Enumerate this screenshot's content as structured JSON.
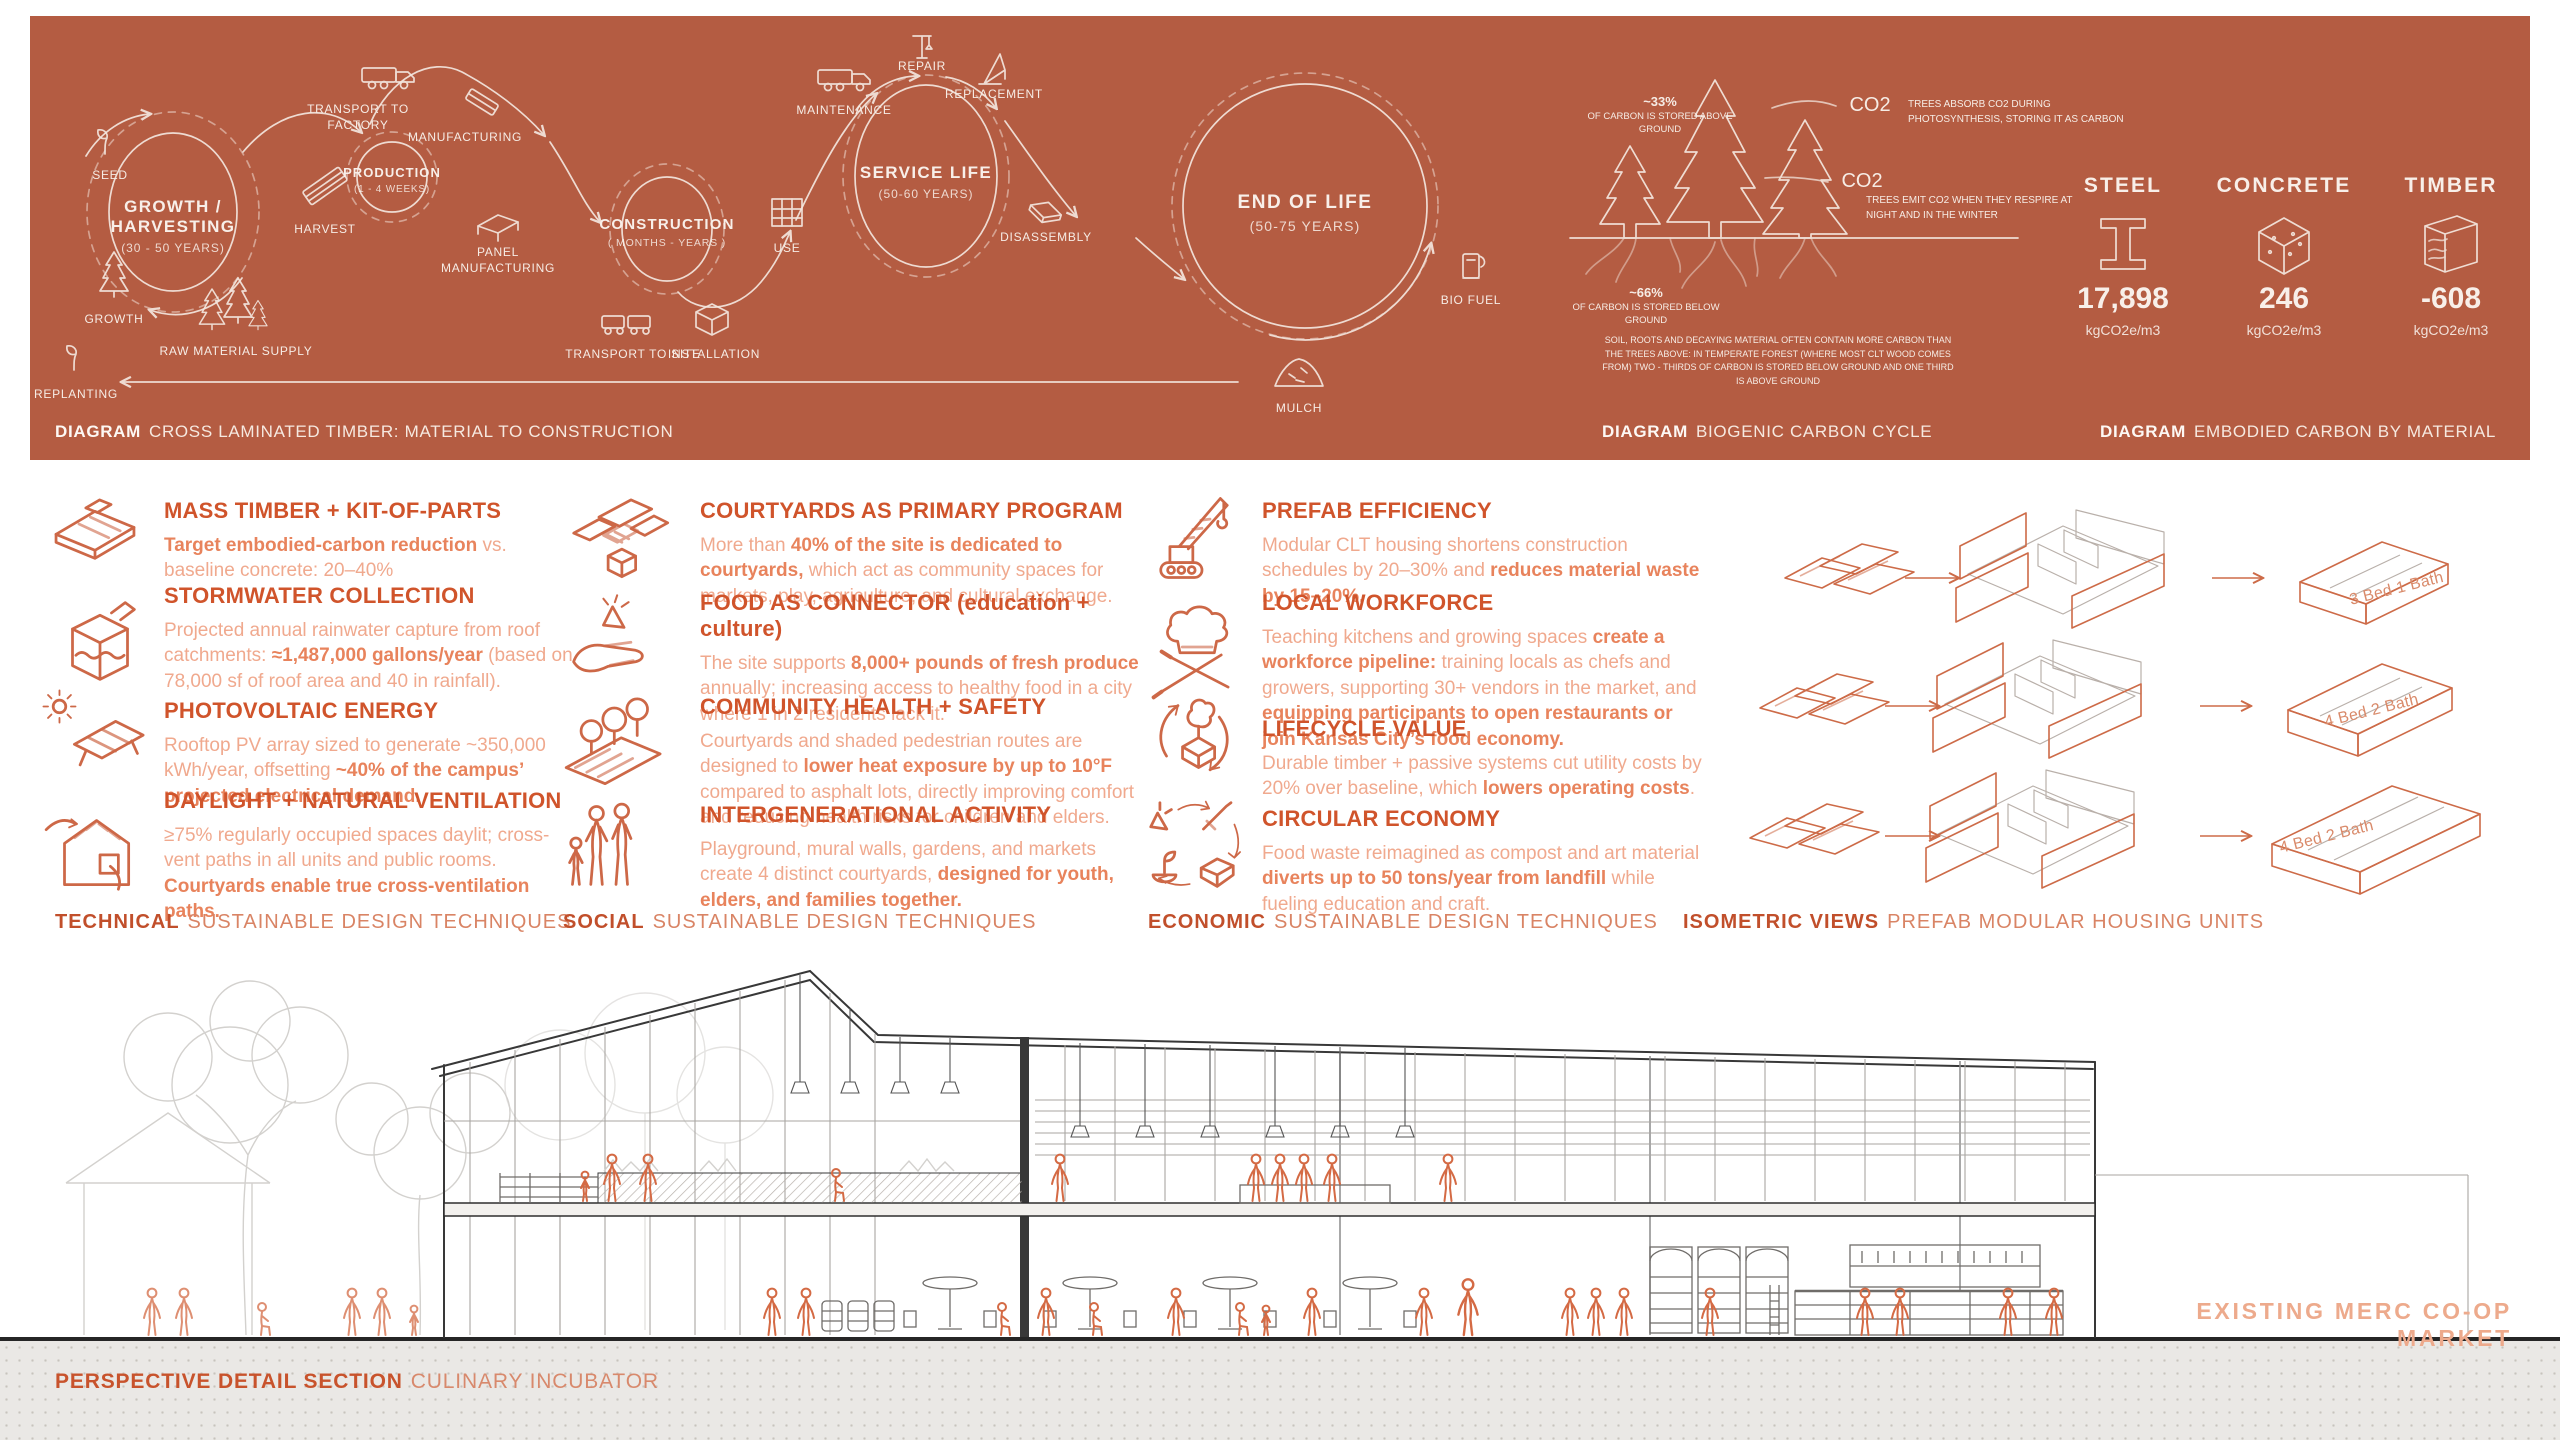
{
  "colors": {
    "band_bg": "#b45c42",
    "accent": "#d0542b",
    "body_light": "#f0a98e",
    "body_bold": "#e8835c",
    "band_ink": "#f6ece5",
    "figure_orange": "#d46a44",
    "ground_gray": "#eae8e5"
  },
  "band": {
    "captions": [
      {
        "tag": "DIAGRAM",
        "title": "CROSS LAMINATED TIMBER: MATERIAL TO CONSTRUCTION"
      },
      {
        "tag": "DIAGRAM",
        "title": "BIOGENIC CARBON CYCLE"
      },
      {
        "tag": "DIAGRAM",
        "title": "EMBODIED CARBON BY MATERIAL"
      }
    ],
    "lifecycle": {
      "circles": [
        {
          "title": "GROWTH / HARVESTING",
          "sub": "(30 - 50 YEARS)"
        },
        {
          "title": "PRODUCTION",
          "sub": "(1 - 4 WEEKS)"
        },
        {
          "title": "CONSTRUCTION",
          "sub": "( MONTHS - YEARS )"
        },
        {
          "title": "SERVICE LIFE",
          "sub": "(50-60 YEARS)"
        },
        {
          "title": "END OF LIFE",
          "sub": "(50-75 YEARS)"
        }
      ],
      "labels": {
        "seed": "SEED",
        "growth": "GROWTH",
        "replanting": "REPLANTING",
        "harvest": "HARVEST",
        "raw_supply": "RAW MATERIAL SUPPLY",
        "to_factory": "TRANSPORT TO FACTORY",
        "manufacturing": "MANUFACTURING",
        "panel_mfg": "PANEL MANUFACTURING",
        "to_site": "TRANSPORT TO SITE",
        "installation": "INSTALLATION",
        "use": "USE",
        "maintenance": "MAINTENANCE",
        "repair": "REPAIR",
        "replacement": "REPLACEMENT",
        "disassembly": "DISASSEMBLY",
        "bio_fuel": "BIO FUEL",
        "mulch": "MULCH"
      }
    },
    "biogenic": {
      "above_pct": "~33%",
      "above_note": "OF CARBON IS STORED ABOVE GROUND",
      "co2_a": "CO2",
      "co2_a_note": "TREES ABSORB CO2 DURING PHOTOSYNTHESIS, STORING IT AS CARBON",
      "co2_b": "CO2",
      "co2_b_note": "TREES EMIT CO2 WHEN THEY RESPIRE AT NIGHT AND IN THE WINTER",
      "below_pct": "~66%",
      "below_note": "OF CARBON IS STORED BELOW GROUND",
      "footnote": "SOIL, ROOTS AND DECAYING MATERIAL OFTEN CONTAIN MORE CARBON THAN THE TREES ABOVE: IN TEMPERATE FOREST (WHERE MOST CLT WOOD COMES FROM) TWO - THIRDS OF CARBON IS STORED BELOW GROUND AND ONE THIRD IS ABOVE GROUND"
    },
    "materials": [
      {
        "name": "STEEL",
        "value": "17,898",
        "unit": "kgCO2e/m3",
        "icon": "steel-ibeam-icon"
      },
      {
        "name": "CONCRETE",
        "value": "246",
        "unit": "kgCO2e/m3",
        "icon": "concrete-cube-icon"
      },
      {
        "name": "TIMBER",
        "value": "-608",
        "unit": "kgCO2e/m3",
        "icon": "timber-block-icon"
      }
    ]
  },
  "features": {
    "technical": {
      "footer": {
        "tag": "TECHNICAL",
        "title": "SUSTAINABLE DESIGN TECHNIQUES"
      },
      "items": [
        {
          "icon": "mass-timber-icon",
          "title": "MASS TIMBER + KIT-OF-PARTS",
          "body": [
            {
              "t": "Target embodied-carbon reduction",
              "b": true
            },
            {
              "t": " vs. baseline concrete: 20–40%",
              "b": false
            }
          ]
        },
        {
          "icon": "stormwater-icon",
          "title": "STORMWATER COLLECTION",
          "body": [
            {
              "t": "Projected annual rainwater capture from roof catchments: ",
              "b": false
            },
            {
              "t": "≈1,487,000 gallons/year",
              "b": true
            },
            {
              "t": " (based on 78,000 sf of roof area and 40 in rainfall).",
              "b": false
            }
          ]
        },
        {
          "icon": "photovoltaic-icon",
          "title": "PHOTOVOLTAIC ENERGY",
          "body": [
            {
              "t": "Rooftop PV array sized to generate ~350,000 kWh/year, offsetting ",
              "b": false
            },
            {
              "t": "~40% of the campus’ projected electrical demand.",
              "b": true
            }
          ]
        },
        {
          "icon": "daylight-ventilation-icon",
          "title": "DAYLIGHT + NATURAL VENTILATION",
          "body": [
            {
              "t": "≥75% regularly occupied spaces daylit; cross-vent paths in all units and public rooms. ",
              "b": false
            },
            {
              "t": "Courtyards enable true cross-ventilation paths.",
              "b": true
            }
          ]
        }
      ]
    },
    "social": {
      "footer": {
        "tag": "SOCIAL",
        "title": "SUSTAINABLE DESIGN TECHNIQUES"
      },
      "items": [
        {
          "icon": "courtyard-icon",
          "title": "COURTYARDS AS PRIMARY PROGRAM",
          "body": [
            {
              "t": "More than ",
              "b": false
            },
            {
              "t": "40% of the site is dedicated to courtyards,",
              "b": true
            },
            {
              "t": " which act as community spaces for markets, play, agriculture, and cultural exchange.",
              "b": false
            }
          ]
        },
        {
          "icon": "food-hand-icon",
          "title": "FOOD AS CONNECTOR (education + culture)",
          "body": [
            {
              "t": "The site supports ",
              "b": false
            },
            {
              "t": "8,000+ pounds of fresh produce",
              "b": true
            },
            {
              "t": " annually; increasing access to healthy food in a city where 1 in 2 residents lack it.",
              "b": false
            }
          ]
        },
        {
          "icon": "shaded-route-icon",
          "title": "COMMUNITY HEALTH + SAFETY",
          "body": [
            {
              "t": "Courtyards and shaded pedestrian routes are designed to ",
              "b": false
            },
            {
              "t": "lower heat exposure by up to 10°F",
              "b": true
            },
            {
              "t": " compared to asphalt lots, directly improving comfort and reducing health risks for children and elders.",
              "b": false
            }
          ]
        },
        {
          "icon": "family-icon",
          "title": "INTERGENERATIONAL ACTIVITY",
          "body": [
            {
              "t": "Playground, mural walls, gardens, and markets create 4 distinct courtyards, ",
              "b": false
            },
            {
              "t": "designed for youth, elders, and families together.",
              "b": true
            }
          ]
        }
      ]
    },
    "economic": {
      "footer": {
        "tag": "ECONOMIC",
        "title": "SUSTAINABLE DESIGN TECHNIQUES"
      },
      "items": [
        {
          "icon": "crane-icon",
          "title": "PREFAB EFFICIENCY",
          "body": [
            {
              "t": "Modular CLT housing shortens construction schedules by 20–30% and ",
              "b": false
            },
            {
              "t": "reduces material waste by 15–20%.",
              "b": true
            }
          ]
        },
        {
          "icon": "chef-icon",
          "title": "LOCAL WORKFORCE",
          "body": [
            {
              "t": "Teaching kitchens and growing spaces ",
              "b": false
            },
            {
              "t": "create a workforce pipeline:",
              "b": true
            },
            {
              "t": " training locals as chefs and growers, supporting 30+ vendors in the market, and ",
              "b": false
            },
            {
              "t": "equipping participants to open restaurants or join Kansas City’s food economy.",
              "b": true
            }
          ]
        },
        {
          "icon": "lifecycle-tree-icon",
          "title": "LIFECYCLE VALUE",
          "body": [
            {
              "t": "Durable timber + passive systems cut utility costs by 20% over baseline, which ",
              "b": false
            },
            {
              "t": "lowers operating costs",
              "b": true
            },
            {
              "t": ".",
              "b": false
            }
          ]
        },
        {
          "icon": "circular-economy-icon",
          "title": "CIRCULAR ECONOMY",
          "body": [
            {
              "t": "Food waste reimagined as compost and art material ",
              "b": false
            },
            {
              "t": "diverts up to 50 tons/year from landfill",
              "b": true
            },
            {
              "t": " while fueling education and craft.",
              "b": false
            }
          ]
        }
      ]
    }
  },
  "iso": {
    "units": [
      "3 Bed 1 Bath",
      "4 Bed 2 Bath",
      "4 Bed 2 Bath"
    ],
    "footer": {
      "tag": "ISOMETRIC VIEWS",
      "title": "PREFAB MODULAR HOUSING UNITS"
    }
  },
  "section": {
    "existing": "EXISTING MERC CO-OP MARKET",
    "caption": {
      "tag": "PERSPECTIVE DETAIL SECTION",
      "title": "CULINARY INCUBATOR"
    }
  }
}
